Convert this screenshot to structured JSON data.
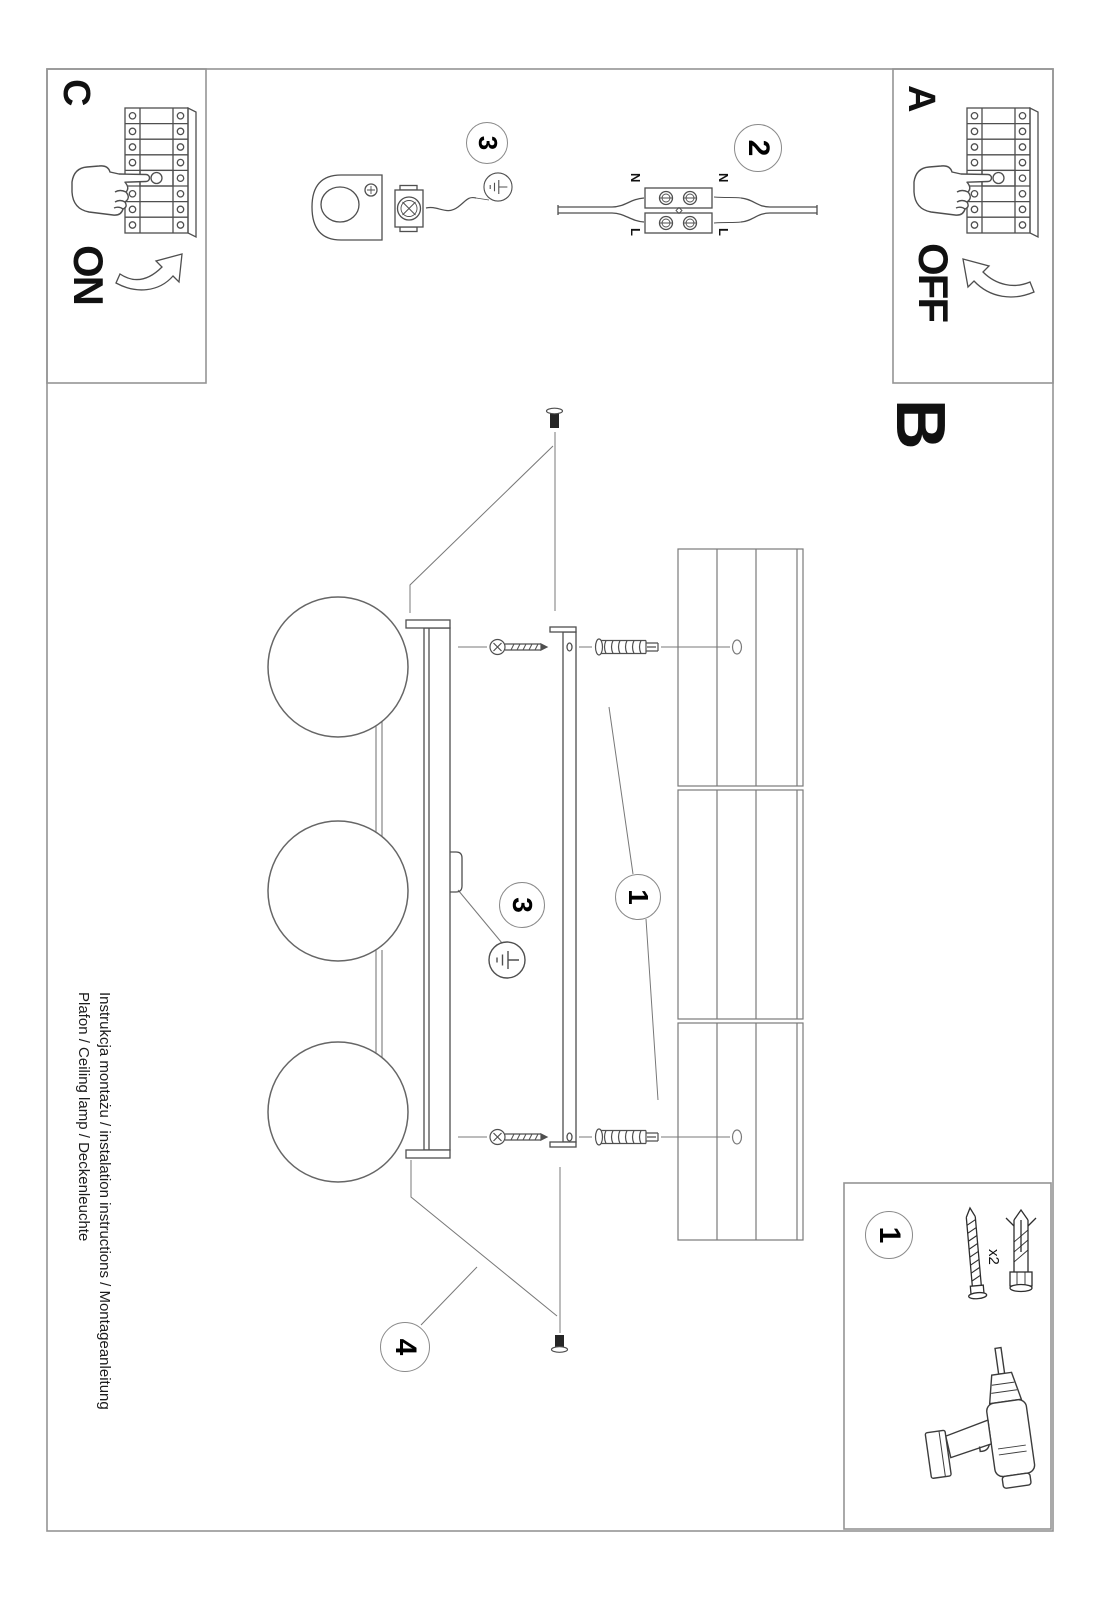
{
  "labels": {
    "a": "A",
    "b": "B",
    "c": "C",
    "on": "ON",
    "off": "OFF"
  },
  "steps": {
    "one": "1",
    "two": "2",
    "three": "3",
    "four": "4"
  },
  "wiring": {
    "neutral": "N",
    "live": "L"
  },
  "parts": {
    "screw_qty": "x2"
  },
  "footer": {
    "line1": "Instrukcja montażu / instalation instructions / Montageanleitung",
    "line2": "Plafon / Ceiling lamp / Deckenleuchte"
  },
  "colors": {
    "line": "#4f4f4f",
    "frame": "#949494",
    "leader": "#787878",
    "ink": "#000000"
  }
}
